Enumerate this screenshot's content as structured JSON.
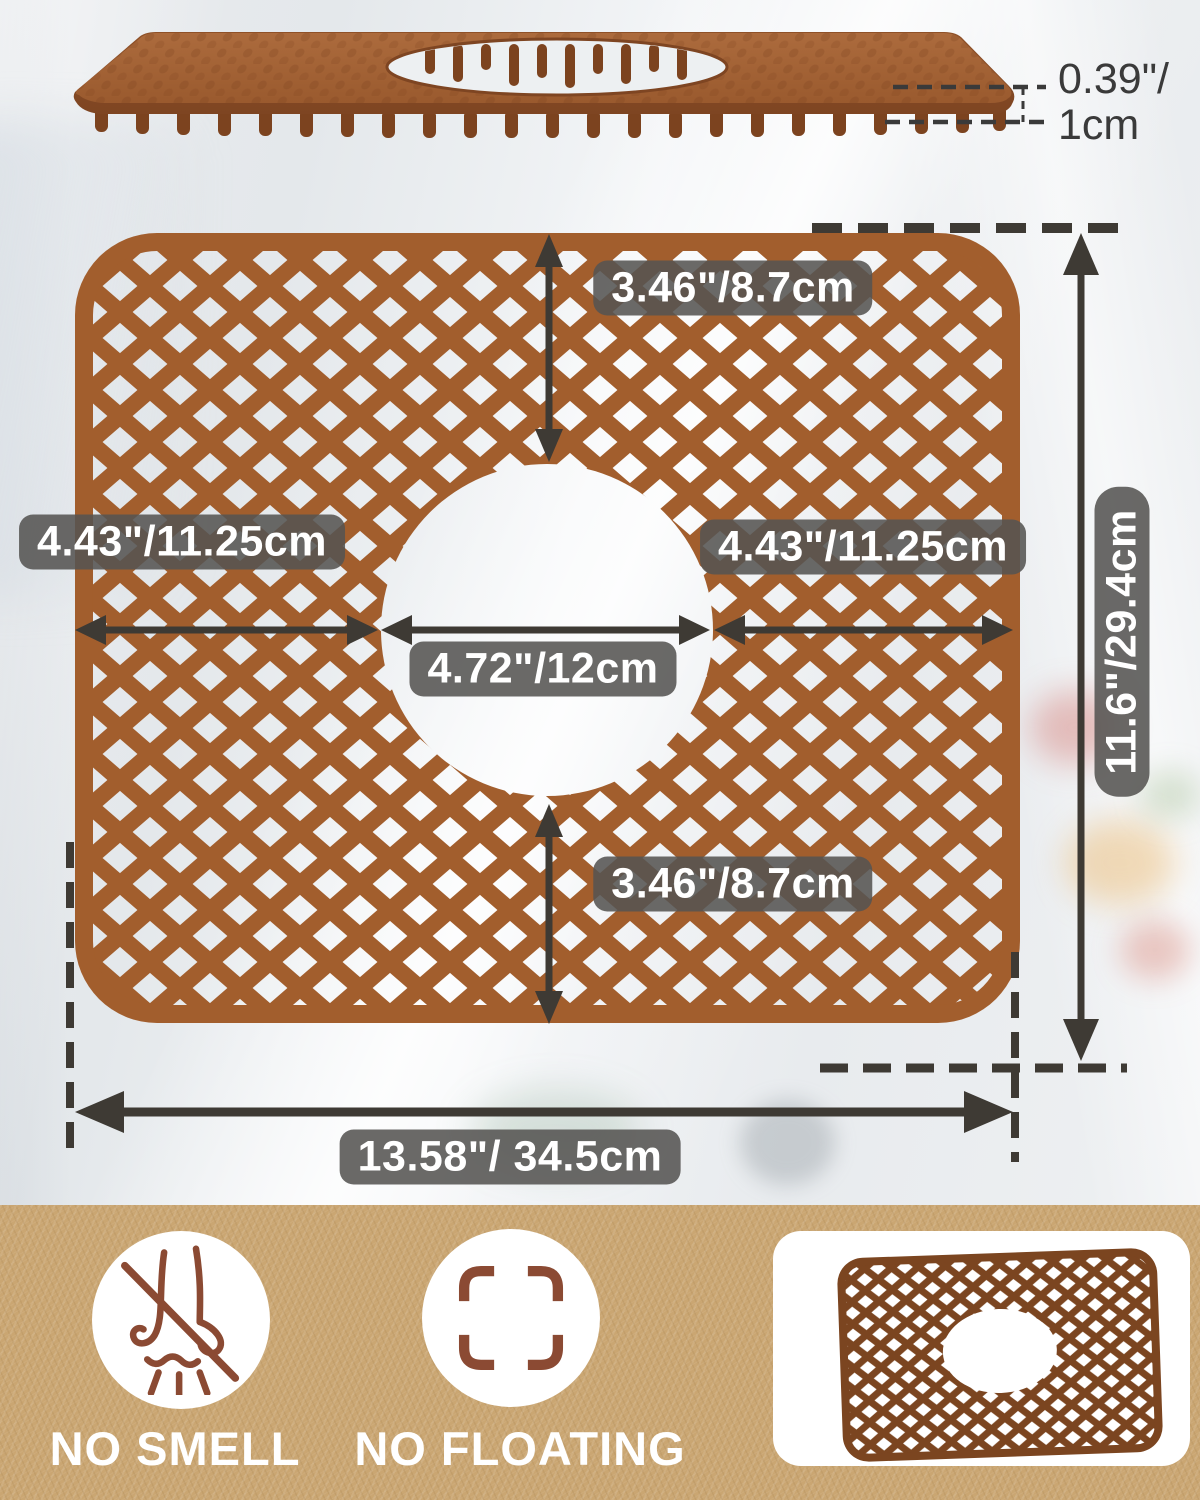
{
  "page_type": "product-dimension-infographic",
  "product_name": "silicone sink mat grid with drain hole",
  "side_view": {
    "thickness_line1": "0.39\"/",
    "thickness_line2": "1cm"
  },
  "top_view": {
    "labels": {
      "top_gap": "3.46\"/8.7cm",
      "left_width": "4.43\"/11.25cm",
      "right_width": "4.43\"/11.25cm",
      "hole_diameter": "4.72\"/12cm",
      "bottom_gap": "3.46\"/8.7cm",
      "total_height": "11.6\"/29.4cm",
      "total_width": "13.58\"/ 34.5cm"
    }
  },
  "features": [
    {
      "icon": "no-smell-nose-icon",
      "label": "NO SMELL"
    },
    {
      "icon": "no-floating-frame-icon",
      "label": "NO FLOATING"
    }
  ],
  "thumbnail": {
    "icon": "product-thumbnail-mini-mat"
  },
  "colors": {
    "mat_brown": "#A25E2D",
    "mat_brown_dark": "#8A4C26",
    "feet_brown": "#7C431F",
    "thumbnail_brown": "#7B4520",
    "dimension_label_bg": "#555452",
    "dimension_text": "#FFFFFF",
    "arrow": "#3E3A34",
    "thickness_text": "#3A3A3A",
    "strip_tan": "#CAA672",
    "icon_brown": "#8B4A33",
    "background": "#ECEFF1"
  }
}
